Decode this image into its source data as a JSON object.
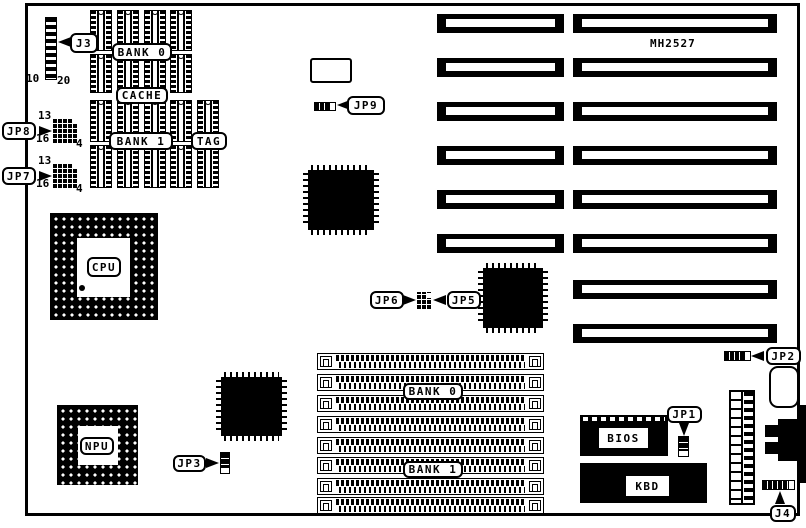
{
  "board": {
    "title": "MH2527",
    "paper": "#ffffff",
    "ink": "#000000",
    "outline": {
      "x": 25,
      "y": 3,
      "w": 775,
      "h": 513
    },
    "title_pos": {
      "x": 650,
      "y": 38
    }
  },
  "callouts": [
    {
      "id": "j3",
      "label": "J3",
      "x": 70,
      "y": 33,
      "w": 28,
      "h": 20,
      "tail": {
        "dir": "left",
        "x": 58,
        "y": 42
      }
    },
    {
      "id": "bank0-cache",
      "label": "BANK 0",
      "x": 112,
      "y": 43,
      "w": 60,
      "h": 18
    },
    {
      "id": "cache",
      "label": "CACHE",
      "x": 116,
      "y": 87,
      "w": 52,
      "h": 17
    },
    {
      "id": "bank1-cache",
      "label": "BANK 1",
      "x": 109,
      "y": 132,
      "w": 64,
      "h": 18
    },
    {
      "id": "tag",
      "label": "TAG",
      "x": 191,
      "y": 132,
      "w": 36,
      "h": 18
    },
    {
      "id": "jp8",
      "label": "JP8",
      "x": 2,
      "y": 122,
      "w": 34,
      "h": 18,
      "tail": {
        "dir": "right",
        "x": 52,
        "y": 131
      }
    },
    {
      "id": "jp7",
      "label": "JP7",
      "x": 2,
      "y": 167,
      "w": 34,
      "h": 18,
      "tail": {
        "dir": "right",
        "x": 52,
        "y": 176
      }
    },
    {
      "id": "cpu",
      "label": "CPU",
      "x": 87,
      "y": 257,
      "w": 34,
      "h": 20
    },
    {
      "id": "npu",
      "label": "NPU",
      "x": 80,
      "y": 437,
      "w": 34,
      "h": 18
    },
    {
      "id": "jp9",
      "label": "JP9",
      "x": 347,
      "y": 96,
      "w": 38,
      "h": 19,
      "tail": {
        "dir": "left",
        "x": 337,
        "y": 105
      }
    },
    {
      "id": "jp6",
      "label": "JP6",
      "x": 370,
      "y": 291,
      "w": 34,
      "h": 18,
      "tail": {
        "dir": "right",
        "x": 416,
        "y": 300
      }
    },
    {
      "id": "jp5",
      "label": "JP5",
      "x": 447,
      "y": 291,
      "w": 34,
      "h": 18,
      "tail": {
        "dir": "left",
        "x": 433,
        "y": 300
      }
    },
    {
      "id": "jp3",
      "label": "JP3",
      "x": 173,
      "y": 455,
      "w": 33,
      "h": 17,
      "tail": {
        "dir": "right",
        "x": 219,
        "y": 463
      }
    },
    {
      "id": "jp1",
      "label": "JP1",
      "x": 667,
      "y": 406,
      "w": 35,
      "h": 17,
      "tail": {
        "dir": "down",
        "x": 684,
        "y": 436
      }
    },
    {
      "id": "jp2",
      "label": "JP2",
      "x": 766,
      "y": 347,
      "w": 35,
      "h": 18,
      "tail": {
        "dir": "left",
        "x": 751,
        "y": 356
      }
    },
    {
      "id": "j4",
      "label": "J4",
      "x": 770,
      "y": 505,
      "w": 26,
      "h": 17,
      "tail": {
        "dir": "up",
        "x": 780,
        "y": 491
      }
    },
    {
      "id": "bank0-simm",
      "label": "BANK 0",
      "x": 403,
      "y": 383,
      "w": 60,
      "h": 17
    },
    {
      "id": "bank1-simm",
      "label": "BANK 1",
      "x": 403,
      "y": 461,
      "w": 60,
      "h": 17
    }
  ],
  "texts": [
    {
      "id": "j3-pin-10",
      "text": "10",
      "x": 26,
      "y": 73
    },
    {
      "id": "j3-pin-20",
      "text": "20",
      "x": 57,
      "y": 75
    },
    {
      "id": "jp8-pin-13",
      "text": "13",
      "x": 38,
      "y": 110
    },
    {
      "id": "jp8-pin-16",
      "text": "16",
      "x": 36,
      "y": 133
    },
    {
      "id": "jp8-pin-4",
      "text": "4",
      "x": 76,
      "y": 138
    },
    {
      "id": "jp7-pin-13",
      "text": "13",
      "x": 38,
      "y": 155
    },
    {
      "id": "jp7-pin-16",
      "text": "16",
      "x": 36,
      "y": 178
    },
    {
      "id": "jp7-pin-4",
      "text": "4",
      "x": 76,
      "y": 183
    }
  ],
  "chip_labels": [
    {
      "id": "bios",
      "text": "BIOS",
      "x": 599,
      "y": 428,
      "w": 49,
      "h": 20
    },
    {
      "id": "kbd",
      "text": "KBD",
      "x": 626,
      "y": 476,
      "w": 43,
      "h": 20
    }
  ],
  "memory": {
    "chip_w": 22,
    "row1_cols": [
      90,
      117,
      144,
      170
    ],
    "row1_chips": [
      {
        "y": 10,
        "h": 41
      },
      {
        "y": 54,
        "h": 39
      }
    ],
    "row2_cols": [
      90,
      117,
      144,
      170,
      197
    ],
    "row2_chips": [
      {
        "y": 100,
        "h": 42
      },
      {
        "y": 145,
        "h": 43
      }
    ]
  },
  "isa_slots": {
    "rows_y": [
      14,
      58,
      102,
      146,
      190,
      234,
      280,
      324
    ],
    "h": 19,
    "left": {
      "x": 437,
      "w": 127,
      "rows": 6
    },
    "right": {
      "x": 573,
      "w": 204,
      "rows": 8
    }
  },
  "simm": {
    "x": 317,
    "w": 227,
    "h": 17,
    "rows_y": [
      353,
      374,
      395,
      416,
      437,
      457,
      478,
      497
    ]
  },
  "sockets": {
    "cpu": {
      "x": 50,
      "y": 213,
      "w": 108,
      "h": 107,
      "window": {
        "x": 27,
        "y": 25,
        "w": 53,
        "h": 59
      },
      "pin1": {
        "x": 29,
        "y": 72
      }
    },
    "npu": {
      "x": 57,
      "y": 405,
      "w": 81,
      "h": 80,
      "window": {
        "x": 21,
        "y": 21,
        "w": 40,
        "h": 39
      }
    }
  },
  "qfps": [
    {
      "id": "chipset-1",
      "x": 303,
      "y": 165,
      "w": 76,
      "h": 70
    },
    {
      "id": "chipset-2",
      "x": 216,
      "y": 372,
      "w": 71,
      "h": 69
    },
    {
      "id": "chipset-3",
      "x": 478,
      "y": 263,
      "w": 70,
      "h": 70
    }
  ],
  "jumpers": {
    "j3_header": {
      "x": 45,
      "y": 17,
      "w": 12,
      "h": 63
    },
    "jp8_block": {
      "x": 53,
      "y": 118,
      "w": 25,
      "h": 25
    },
    "jp7_block": {
      "x": 53,
      "y": 163,
      "w": 25,
      "h": 25
    },
    "jp56_block": {
      "x": 417,
      "y": 292,
      "w": 15,
      "h": 17
    },
    "jp9_strip": {
      "x": 314,
      "y": 102,
      "w": 22,
      "h": 9
    },
    "jp2_strip": {
      "x": 724,
      "y": 351,
      "w": 27,
      "h": 10
    },
    "j4_strip": {
      "x": 762,
      "y": 480,
      "w": 33,
      "h": 10
    },
    "jp1_strip": {
      "x": 678,
      "y": 436,
      "w": 11,
      "h": 21
    },
    "jp3_strip": {
      "x": 220,
      "y": 452,
      "w": 10,
      "h": 22
    }
  },
  "misc": {
    "crystal": {
      "x": 310,
      "y": 58,
      "w": 42,
      "h": 25
    },
    "battery": {
      "x": 769,
      "y": 366,
      "w": 30,
      "h": 42
    },
    "power_connector": {
      "x": 729,
      "y": 390,
      "w": 26,
      "h": 115
    },
    "bios_chip": {
      "x": 580,
      "y": 415,
      "w": 88,
      "h": 41
    },
    "kbd_chip": {
      "x": 580,
      "y": 463,
      "w": 127,
      "h": 40
    },
    "din_body": {
      "x": 778,
      "y": 419,
      "w": 28,
      "h": 42
    },
    "din_tab1": {
      "x": 765,
      "y": 425,
      "w": 14,
      "h": 12
    },
    "din_tab2": {
      "x": 765,
      "y": 442,
      "w": 14,
      "h": 12
    },
    "edge_stub1": {
      "x": 799,
      "y": 405,
      "w": 7,
      "h": 15
    },
    "edge_stub2": {
      "x": 799,
      "y": 458,
      "w": 7,
      "h": 25
    }
  }
}
